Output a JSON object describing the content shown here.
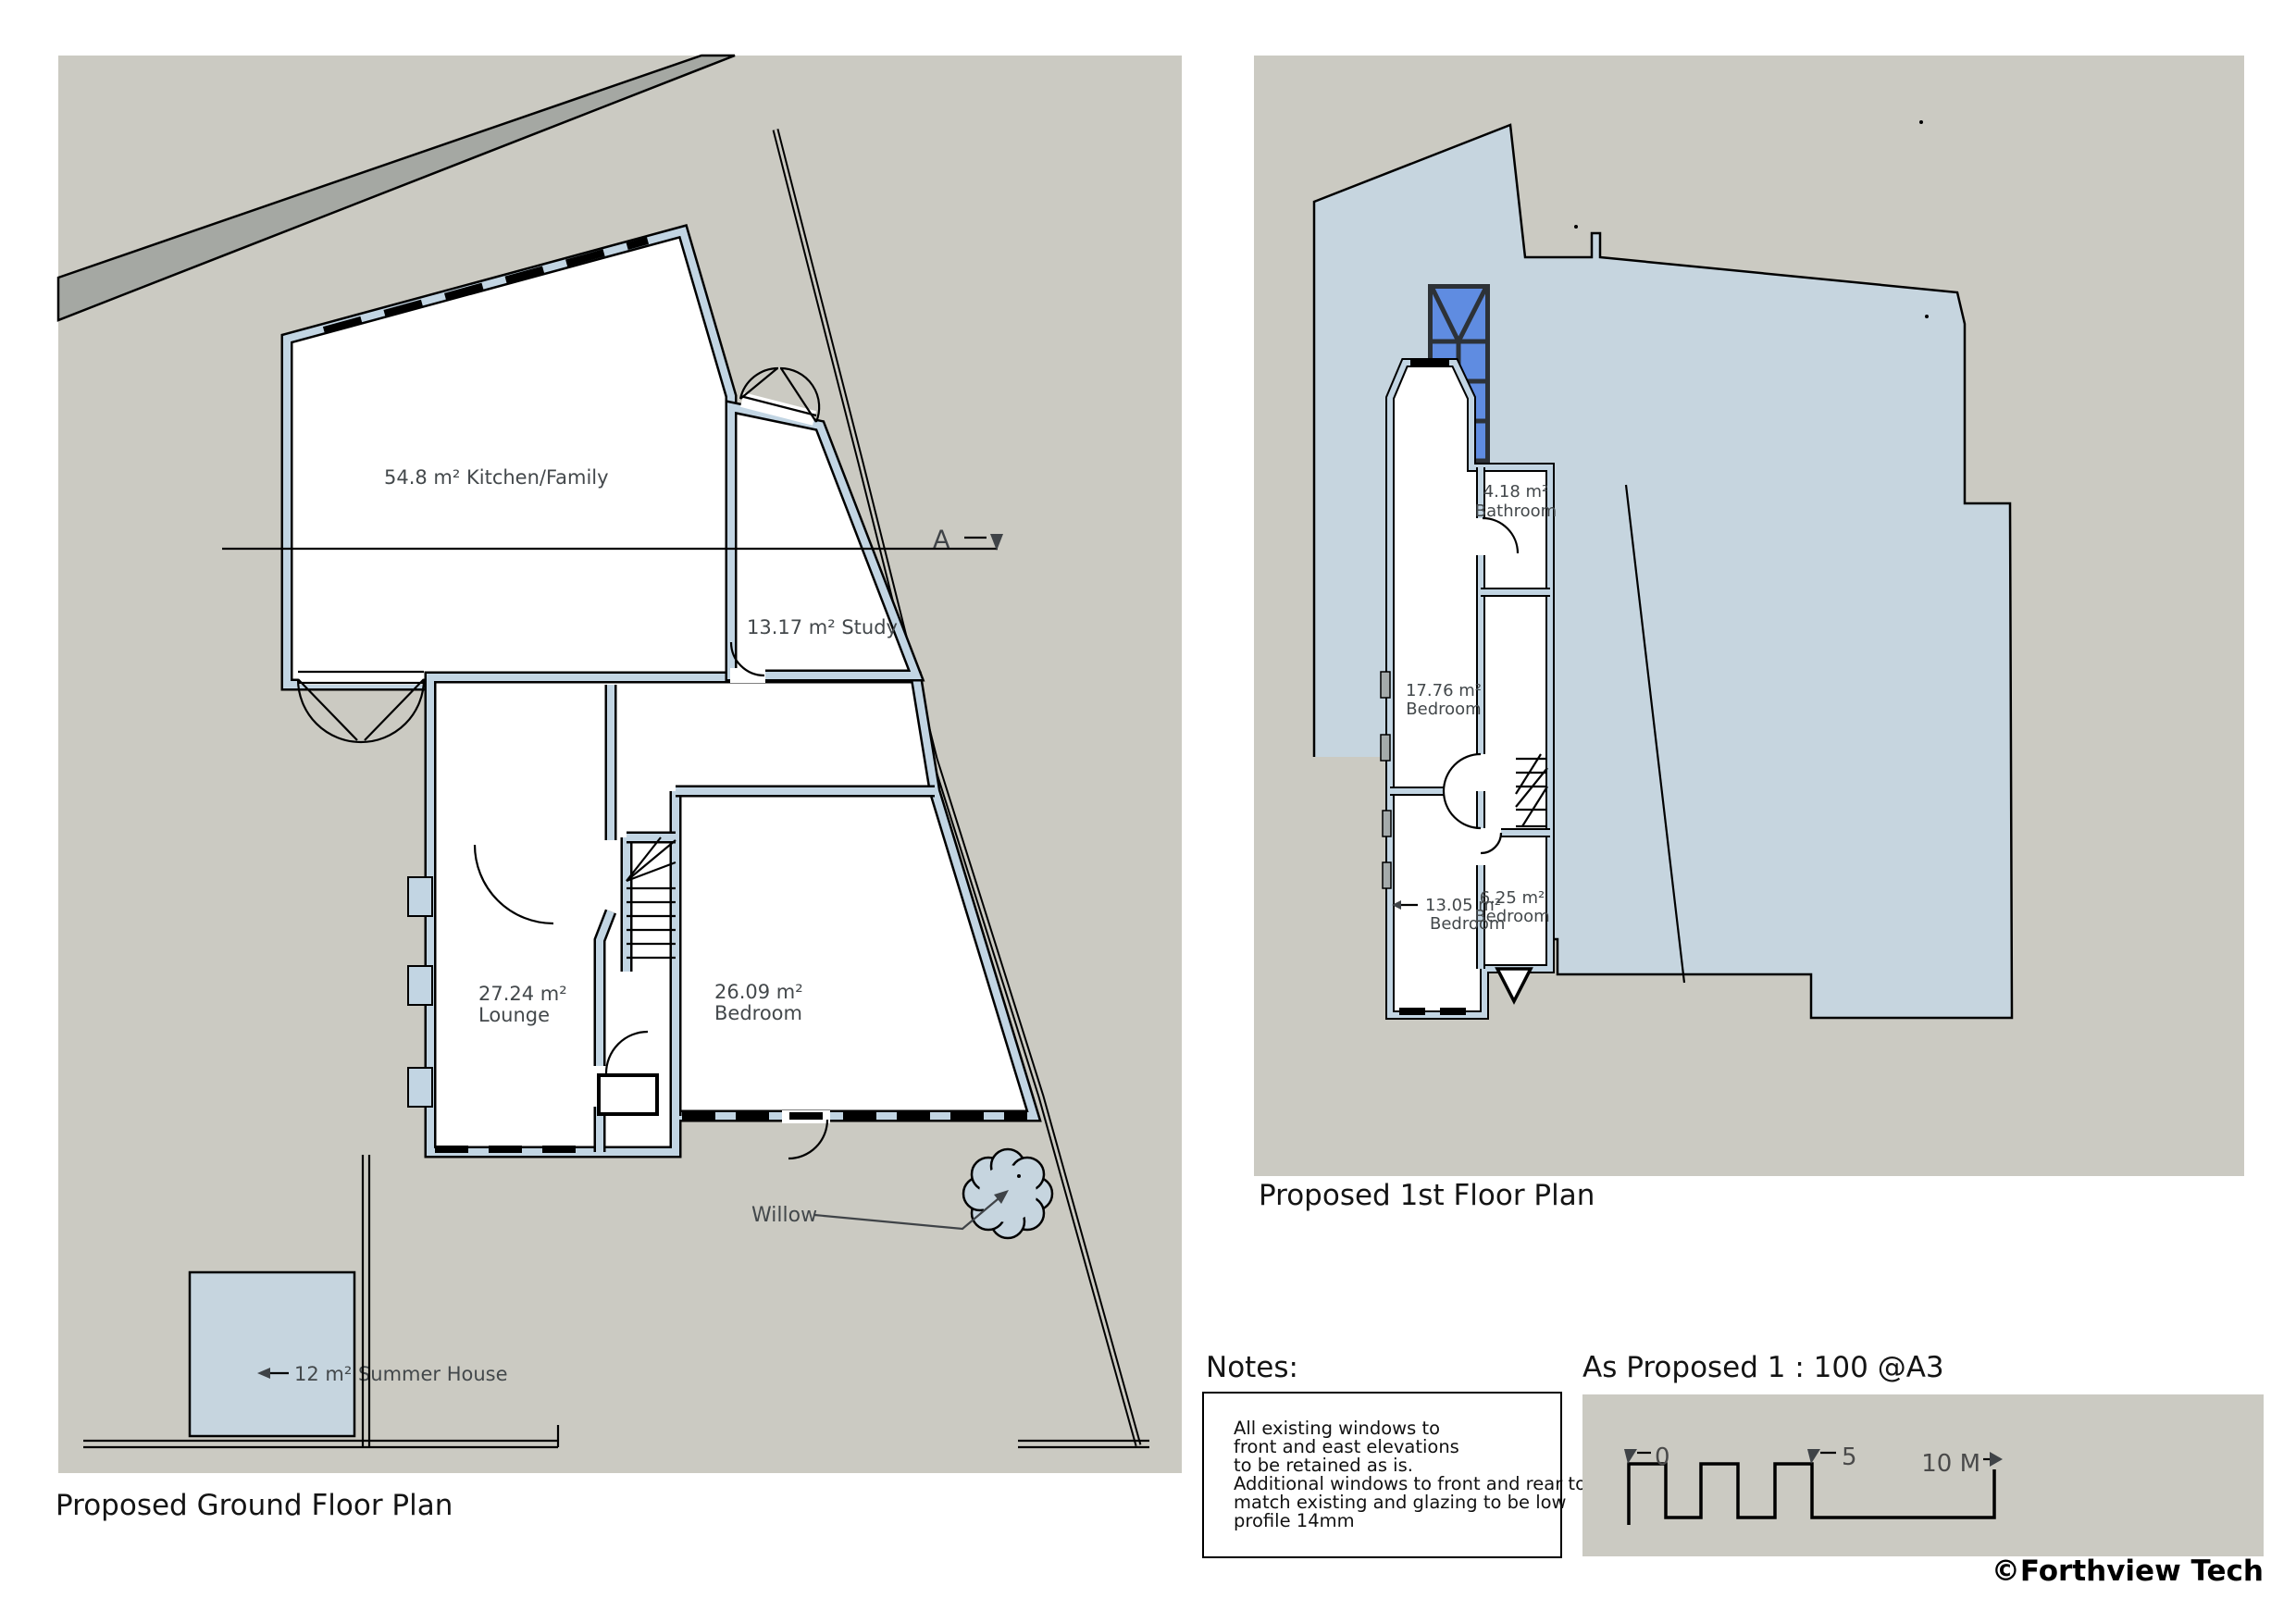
{
  "ground_floor": {
    "title": "Proposed Ground Floor Plan",
    "kitchen_label": "54.8 m² Kitchen/Family",
    "study_label": "13.17 m² Study",
    "lounge": {
      "area": "27.24 m²",
      "name": "Lounge"
    },
    "bedroom": {
      "area": "26.09 m²",
      "name": "Bedroom"
    },
    "summer_house_label": "12 m² Summer House",
    "willow_label": "Willow",
    "section_marker": "A"
  },
  "first_floor": {
    "title": "Proposed 1st Floor Plan",
    "bedroom_main": {
      "area": "17.76 m²",
      "name": "Bedroom"
    },
    "bathroom": {
      "area": "4.18 m²",
      "name": "Bathroom"
    },
    "bedroom_rear": {
      "area": "13.05 m²",
      "name": "Bedroom"
    },
    "bedroom_small": {
      "area": "6.25 m²",
      "name": "Bedroom"
    }
  },
  "notes": {
    "heading": "Notes:",
    "lines": [
      "All existing windows to",
      "front and east elevations",
      "to be retained as is.",
      "Additional windows to front and rear to",
      "match existing and glazing to be low",
      "profile 14mm"
    ]
  },
  "scale_bar": {
    "title": "As Proposed 1 : 100 @A3",
    "tick_zero": "0",
    "tick_five": "5",
    "tick_ten": "10 M"
  },
  "credit": "©Forthview Tech",
  "colors": {
    "site": "#cbcac2",
    "wall": "#c2d5e3",
    "roof": "#c6d5df",
    "glass": "#5f8ce1",
    "road": "#a5a8a3"
  }
}
